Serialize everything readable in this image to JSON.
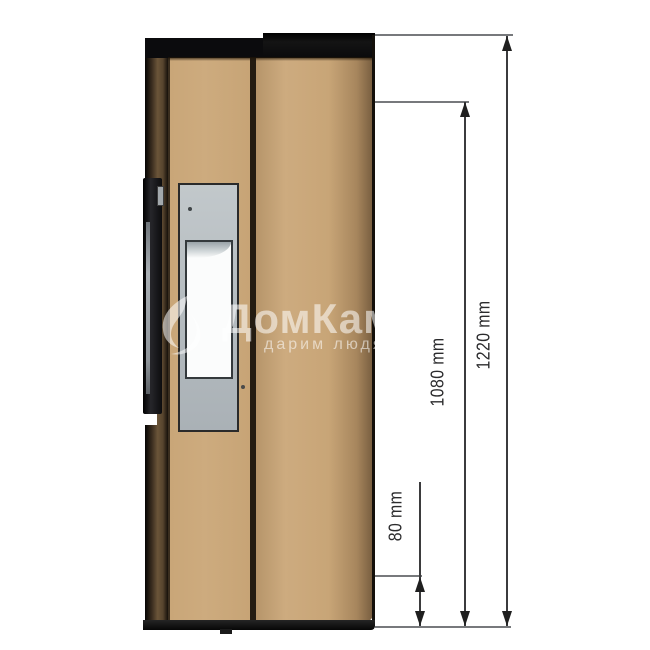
{
  "diagram": {
    "subject": "stove-side-view-dimension-drawing",
    "dims": {
      "overall_height": {
        "label": "1220 mm"
      },
      "mid_height": {
        "label": "1080 mm"
      },
      "base_offset": {
        "label": "80 mm"
      }
    },
    "colors": {
      "body_tan": "#C9A678",
      "cap_black": "#0B0B0D",
      "rear_brown": "#5C4A33",
      "door_gray": "#B6BCC0",
      "glass_white": "#FBFCFC",
      "dim_line_gray": "#77797C",
      "dim_text": "#2B2B2D",
      "background": "#FFFFFF"
    }
  },
  "watermark": {
    "title": "ДомКамин",
    "subtitle": "дарим людям"
  }
}
